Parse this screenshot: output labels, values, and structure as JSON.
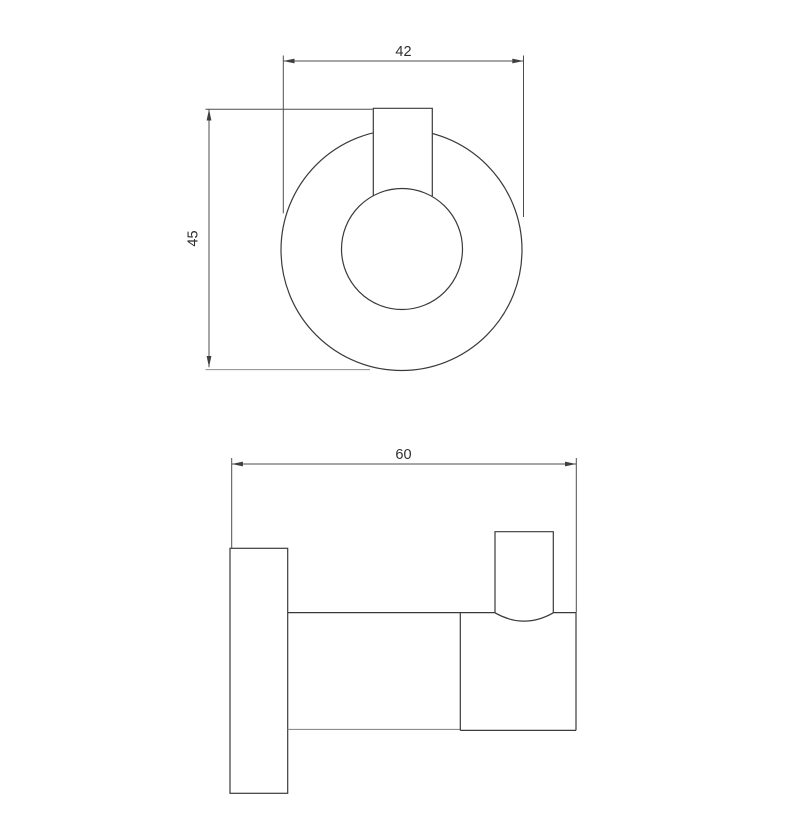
{
  "canvas": {
    "width": 807,
    "height": 824,
    "background": "#ffffff",
    "line_color": "#3a3a3a",
    "dim_line_color": "#4d4d4d",
    "light_line_color": "#8d8d8d",
    "text_color": "#2f2f2f"
  },
  "drawing": {
    "views": {
      "top_view": {
        "dims": {
          "width": {
            "label": "42",
            "value": 42,
            "orientation": "horizontal"
          },
          "height": {
            "label": "45",
            "value": 45,
            "orientation": "vertical"
          }
        }
      },
      "side_view": {
        "dims": {
          "depth": {
            "label": "60",
            "value": 60,
            "orientation": "horizontal"
          }
        }
      }
    }
  }
}
